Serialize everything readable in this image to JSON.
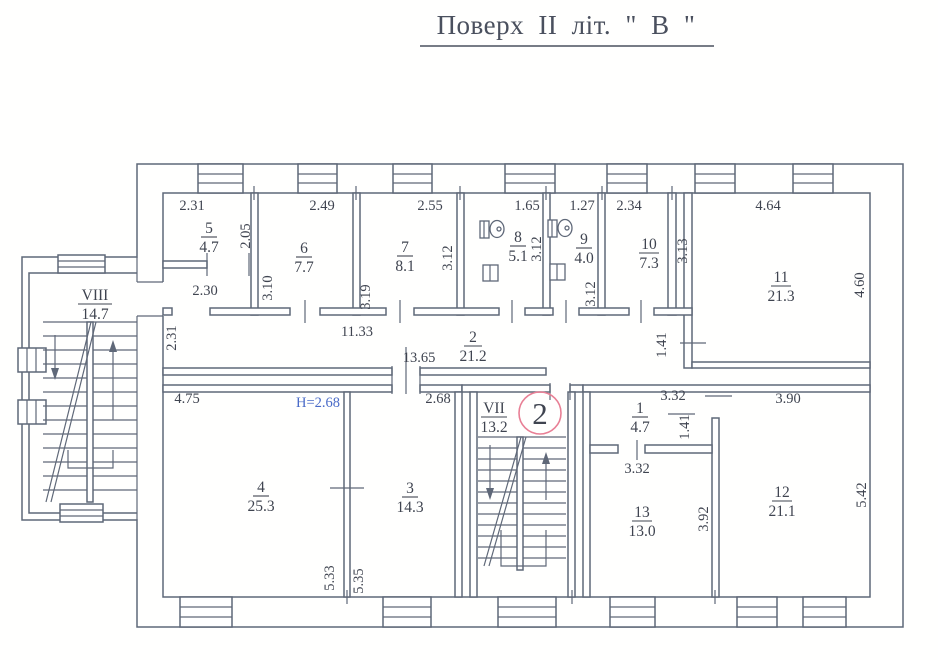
{
  "title": "Поверх II літ. \" В \"",
  "marker": {
    "label": "2"
  },
  "colors": {
    "line": "#5f6878",
    "text": "#3f4450",
    "height_note": "#4a6bc8",
    "marker_ring": "#e87f95"
  },
  "rooms": {
    "r5": {
      "num": "5",
      "area": "4.7"
    },
    "r6": {
      "num": "6",
      "area": "7.7"
    },
    "r7": {
      "num": "7",
      "area": "8.1"
    },
    "r8": {
      "num": "8",
      "area": "5.1"
    },
    "r9": {
      "num": "9",
      "area": "4.0"
    },
    "r10": {
      "num": "10",
      "area": "7.3"
    },
    "r11": {
      "num": "11",
      "area": "21.3"
    },
    "corridor": {
      "num": "2",
      "area": "21.2"
    },
    "stair8": {
      "num": "VIII",
      "area": "14.7"
    },
    "stair7": {
      "num": "VII",
      "area": "13.2"
    },
    "r4": {
      "num": "4",
      "area": "25.3"
    },
    "r3": {
      "num": "3",
      "area": "14.3"
    },
    "r1": {
      "num": "1",
      "area": "4.7"
    },
    "r13": {
      "num": "13",
      "area": "13.0"
    },
    "r12": {
      "num": "12",
      "area": "21.1"
    }
  },
  "dims": {
    "w5": "2.31",
    "w6": "2.49",
    "w7": "2.55",
    "w8": "1.65",
    "w9": "1.27",
    "w10": "2.34",
    "w11": "4.64",
    "h5": "2.05",
    "h6": "3.10",
    "h7l": "3.19",
    "h7r": "3.12",
    "h8": "3.12",
    "h9": "3.12",
    "h10": "3.13",
    "h11": "4.60",
    "lobby_w": "2.30",
    "lobby_h": "2.31",
    "span_upper": "11.33",
    "corr_len": "13.65",
    "corr_w": "1.41",
    "w4": "4.75",
    "w3": "2.68",
    "note_h": "H=2.68",
    "h4": "5.33",
    "h3": "5.35",
    "w1": "3.32",
    "h1": "1.41",
    "w13": "3.32",
    "h13": "3.92",
    "w12": "3.90",
    "h12": "5.42"
  }
}
